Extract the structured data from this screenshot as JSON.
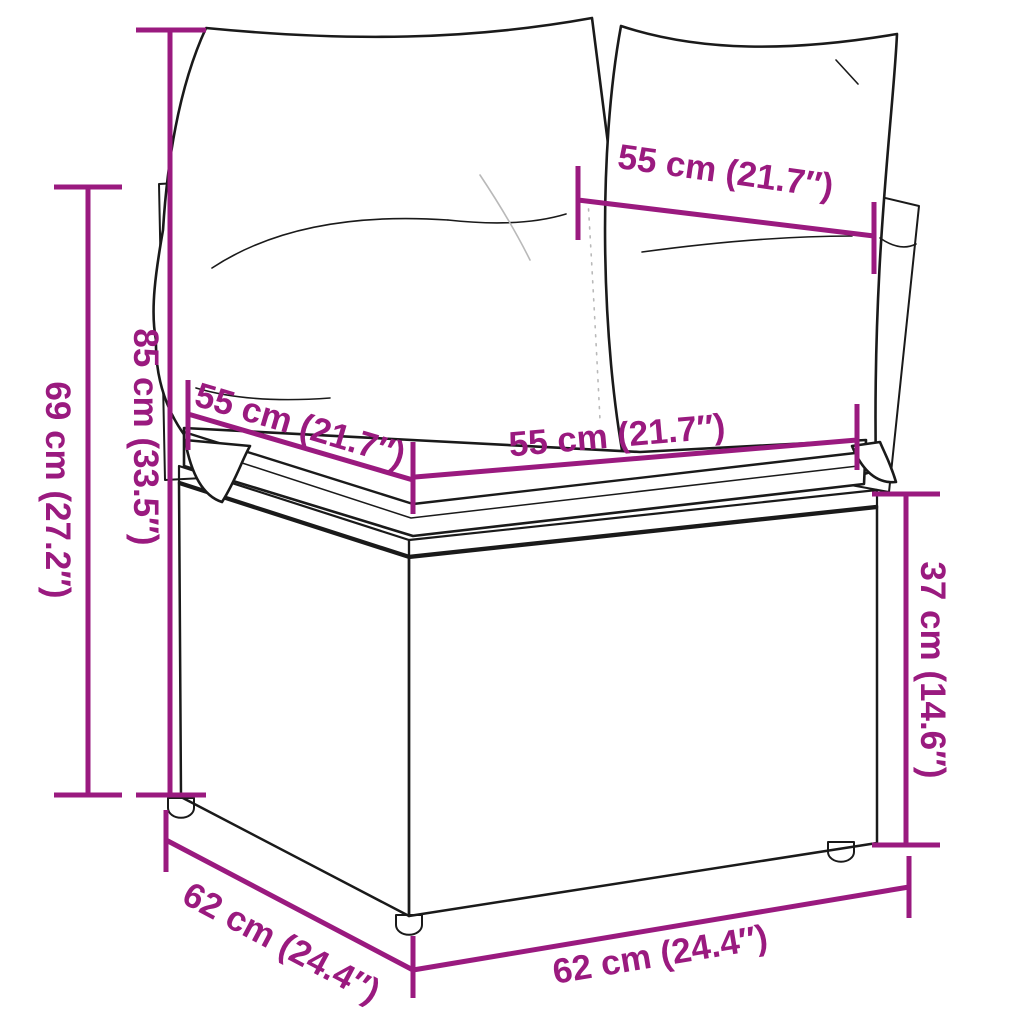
{
  "diagram": {
    "subject": "poly rattan corner sofa section with back cushions and seat cushion",
    "colors": {
      "dimension_accent": "#9A1A7F",
      "line_art": "#1A1A1A",
      "background": "#FFFFFF",
      "cushion_fill": "#FFFFFF"
    },
    "annotations": {
      "back_cushion_width": {
        "label": "55 cm (21.7″)"
      },
      "total_height": {
        "label": "85 cm (33.5″)"
      },
      "frame_height": {
        "label": "69 cm (27.2″)"
      },
      "seat_depth_side": {
        "label": "55 cm (21.7″)"
      },
      "seat_width_front": {
        "label": "55 cm (21.7″)"
      },
      "seat_height": {
        "label": "37 cm (14.6″)"
      },
      "base_depth_side": {
        "label": "62 cm (24.4″)"
      },
      "base_width_front": {
        "label": "62 cm (24.4″)"
      }
    }
  }
}
